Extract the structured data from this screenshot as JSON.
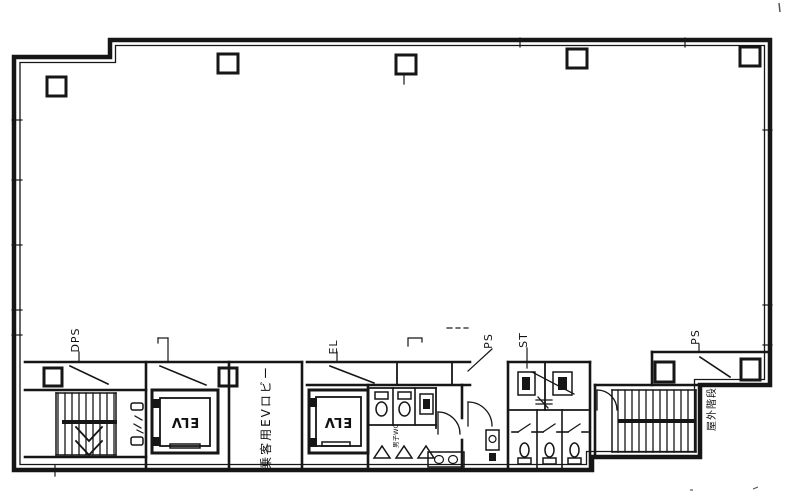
{
  "plan": {
    "type": "architectural-floor-plan",
    "labels": {
      "dps": "DPS",
      "el": "EL",
      "ps_center": "PS",
      "st": "ST",
      "ps_right": "PS",
      "elv_left": "ELV",
      "elv_right": "ELV",
      "lobby_vertical": "乗客用EVロビー",
      "outdoor_stairs_vertical": "屋外階段",
      "mens_wc_vertical": "男子WC"
    },
    "colors": {
      "ink": "#161616",
      "paper": "#ffffff"
    }
  }
}
